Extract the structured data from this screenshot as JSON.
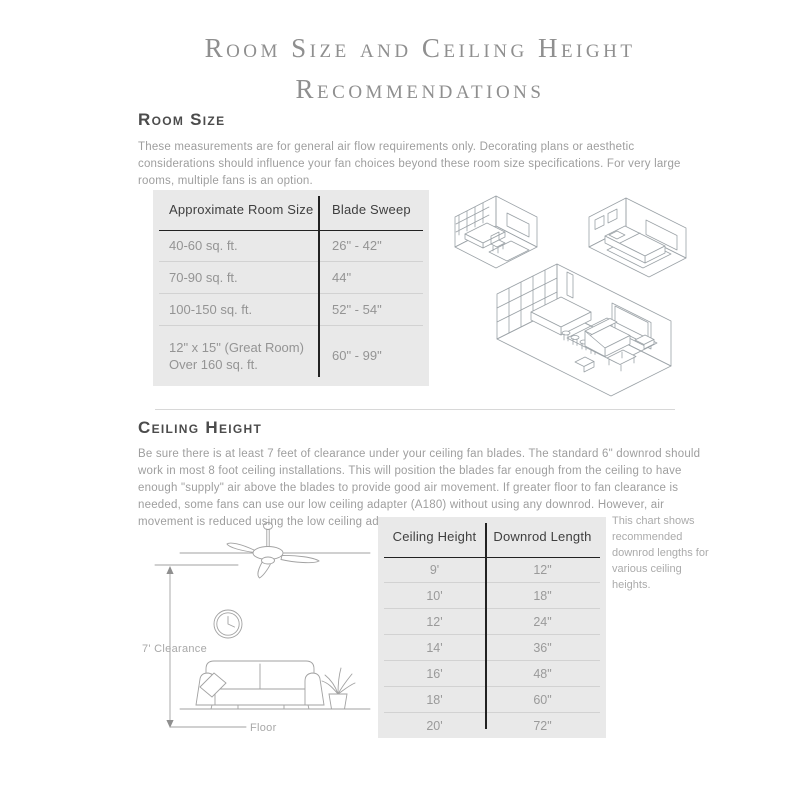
{
  "page": {
    "title_line1": "Room Size and Ceiling Height",
    "title_line2": "Recommendations"
  },
  "room_size_section": {
    "heading": "Room Size",
    "description": "These measurements are for general air flow requirements only. Decorating plans or aesthetic considerations should influence your fan choices beyond these room size specifications. For very large rooms, multiple fans is an option.",
    "table": {
      "columns": [
        "Approximate Room Size",
        "Blade Sweep"
      ],
      "rows": [
        [
          "40-60 sq. ft.",
          "26\" - 42\""
        ],
        [
          "70-90 sq. ft.",
          "44\""
        ],
        [
          "100-150 sq. ft.",
          "52\" - 54\""
        ],
        [
          "12\" x 15\" (Great Room)\nOver 160 sq. ft.",
          "60\" - 99\""
        ]
      ]
    }
  },
  "ceiling_height_section": {
    "heading": "Ceiling Height",
    "description": "Be sure there is at least 7 feet of clearance under your ceiling fan blades. The standard 6\" downrod should work in most 8 foot ceiling installations. This will position the blades far enough from the ceiling to have enough \"supply\" air above the blades to provide good air movement. If greater floor to fan clearance is needed, some fans can use our low ceiling adapter (A180) without using any downrod. However, air movement is reduced using the low ceiling adapter.",
    "illustration": {
      "clearance_label": "7' Clearance",
      "floor_label": "Floor"
    },
    "table": {
      "columns": [
        "Ceiling Height",
        "Downrod Length"
      ],
      "rows": [
        [
          "9'",
          "12\""
        ],
        [
          "10'",
          "18\""
        ],
        [
          "12'",
          "24\""
        ],
        [
          "14'",
          "36\""
        ],
        [
          "16'",
          "48\""
        ],
        [
          "18'",
          "60\""
        ],
        [
          "20'",
          "72\""
        ]
      ]
    },
    "note": "This chart shows recommended downrod lengths for various ceiling heights."
  },
  "colors": {
    "title_text": "#8f8f8f",
    "heading_text": "#4c4c4c",
    "body_text": "#9e9e9e",
    "table_background": "#e9e9e9",
    "table_header_text": "#3f3f3f",
    "table_cell_text": "#949494",
    "table_rule_dark": "#222222",
    "table_rule_light": "#d2d2d2",
    "illustration_stroke": "#9ba2a7"
  }
}
